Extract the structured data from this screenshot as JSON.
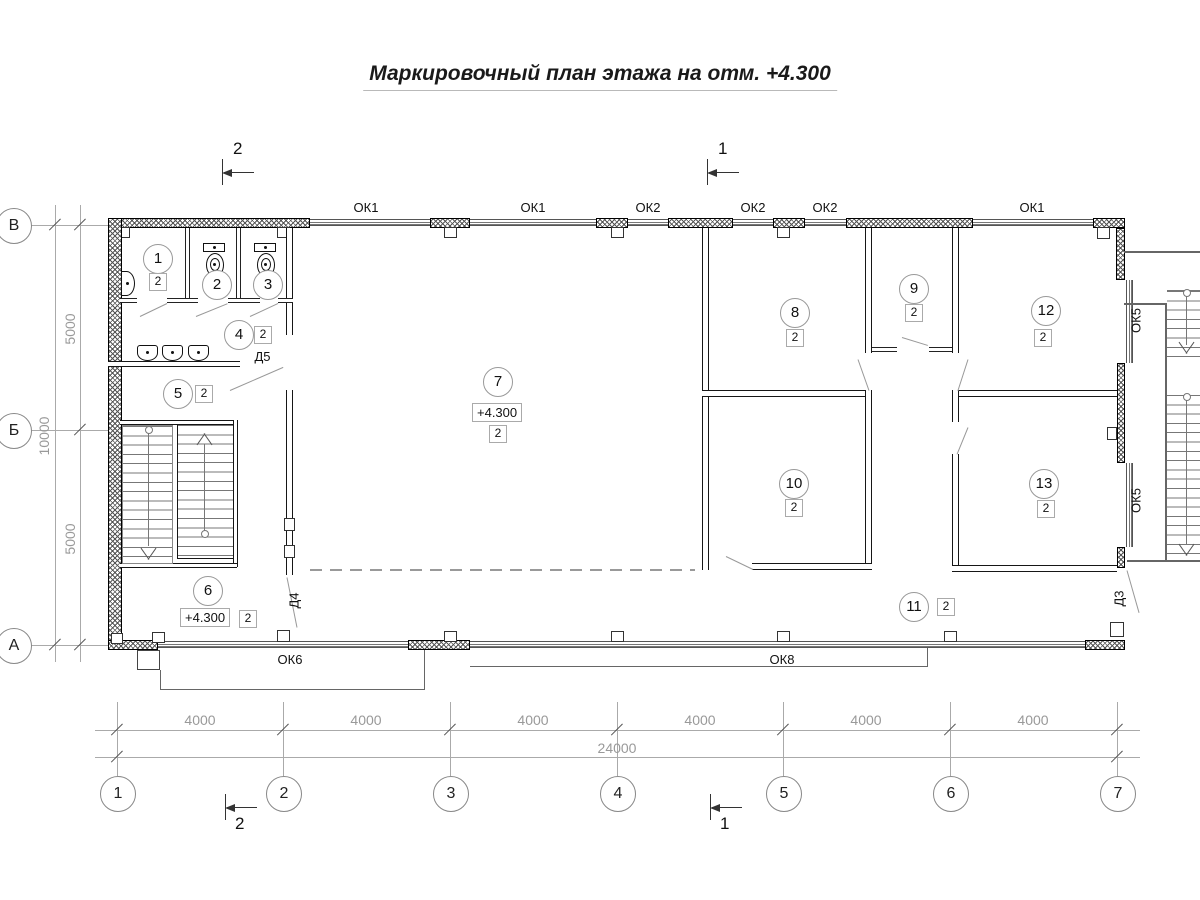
{
  "title": "Маркировочный план этажа на отм. +4.300",
  "sections": {
    "s1": "1",
    "s2": "2"
  },
  "grid": {
    "columns": [
      "1",
      "2",
      "3",
      "4",
      "5",
      "6",
      "7"
    ],
    "rows": [
      "В",
      "Б",
      "А"
    ]
  },
  "dimensions": {
    "bay": "4000",
    "total": "24000",
    "row_span": "5000",
    "row_total": "10000"
  },
  "windows": {
    "ok1": "ОК1",
    "ok2": "ОК2",
    "ok5": "ОК5",
    "ok6": "ОК6",
    "ok8": "ОК8"
  },
  "doors": {
    "d3": "Д3",
    "d4": "Д4",
    "d5": "Д5"
  },
  "elevation": "+4.300",
  "finish_code": "2",
  "rooms": {
    "r1": "1",
    "r2": "2",
    "r3": "3",
    "r4": "4",
    "r5": "5",
    "r6": "6",
    "r7": "7",
    "r8": "8",
    "r9": "9",
    "r10": "10",
    "r11": "11",
    "r12": "12",
    "r13": "13"
  }
}
